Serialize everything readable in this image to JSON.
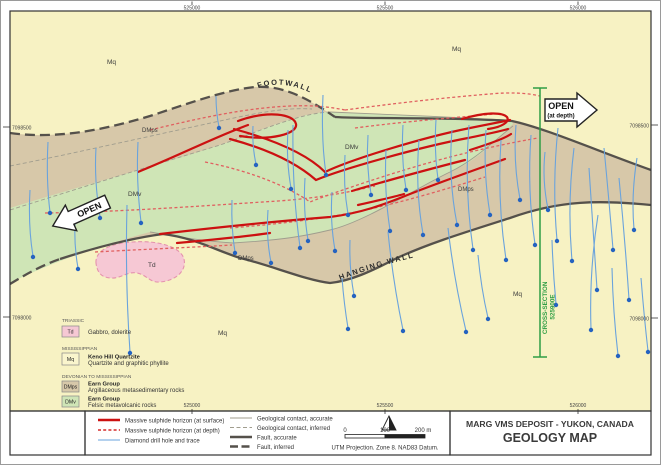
{
  "title_block": {
    "line1": "MARG VMS DEPOSIT - YUKON, CANADA",
    "line2": "GEOLOGY MAP"
  },
  "coords": {
    "top": [
      "525000",
      "525500",
      "526000"
    ],
    "bottom": [
      "525000",
      "525500",
      "526000"
    ],
    "left": [
      "7098500",
      "7098000"
    ],
    "right": [
      "7098500",
      "7098000"
    ]
  },
  "annotations": {
    "footwall": "FOOTWALL",
    "hanging_wall": "HANGING WALL",
    "open_left": "OPEN",
    "open_right": "OPEN",
    "open_right_sub": "(at depth)",
    "cross_section": "CROSS-SECTION",
    "cross_section_easting": "525900E"
  },
  "unit_labels": {
    "mq": "Mq",
    "dmps": "DMps",
    "dmv": "DMv",
    "td": "Td"
  },
  "strat_legend": {
    "era1": "TRIASSIC",
    "td_code": "Td",
    "td_desc": "Gabbro, dolerite",
    "era2": "MISSISSIPPIAN",
    "mq_code": "Mq",
    "mq_name": "Keno Hill Quartzite",
    "mq_desc": "Quartzite and graphitic phyllite",
    "era3": "DEVONIAN TO MISSISSIPPIAN",
    "dmps_code": "DMps",
    "dmps_name": "Earn Group",
    "dmps_desc": "Argillaceous metasedimentary rocks",
    "dmv_code": "DMv",
    "dmv_name": "Earn Group",
    "dmv_desc": "Felsic metavolcanic rocks"
  },
  "symbol_legend": {
    "sulphide_surface": "Massive sulphide horizon (at surface)",
    "sulphide_depth": "Massive sulphide horizon (at depth)",
    "drill_hole": "Diamond drill hole and trace",
    "contact_accurate": "Geological contact, accurate",
    "contact_inferred": "Geological contact, inferred",
    "fault_accurate": "Fault, accurate",
    "fault_inferred": "Fault, inferred"
  },
  "scale": {
    "t0": "0",
    "t100": "100",
    "t200": "200 m",
    "datum": "UTM Projection. Zone 8. NAD83 Datum."
  },
  "icons": {
    "north_arrow": "north-arrow"
  },
  "colors": {
    "mq": "#f7f2c3",
    "dmps": "#d7c8a9",
    "dmv": "#cfe5b6",
    "td": "#f6c8d4",
    "td_outline": "#e493ad",
    "fault": "#55514b",
    "contact": "#a09d8e",
    "sulphide_surface": "#cc1111",
    "sulphide_depth": "#e06060",
    "drill": "#6aa3dc",
    "drill_dot": "#2563c0",
    "cross_section": "#2f9e44"
  }
}
